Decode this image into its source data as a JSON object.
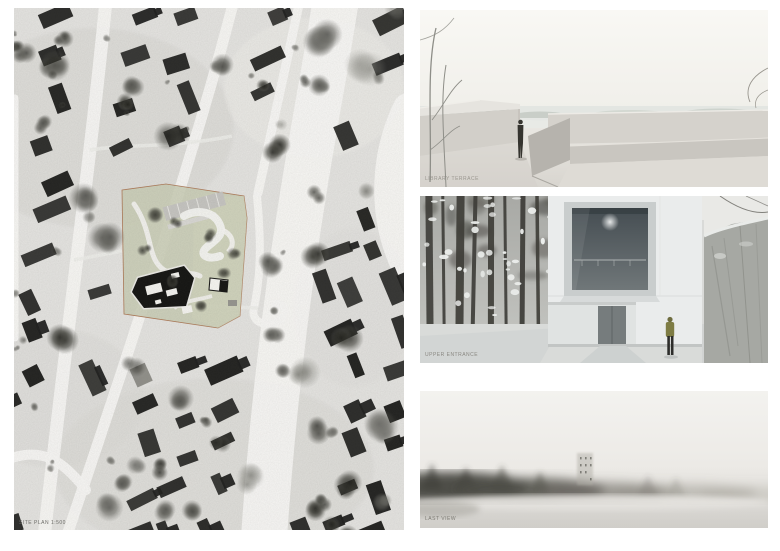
{
  "board": {
    "type_label": "architectural presentation board"
  },
  "site_plan": {
    "label": "SITE PLAN 1:500",
    "colors": {
      "paper": "#e5e4e1",
      "road": "#f8f7f5",
      "building": "#1f1f1d",
      "shed": "#8d8c87",
      "site_fill": "#c9ccb4",
      "site_outline": "#ad7a58",
      "plan_building": "#141412"
    }
  },
  "renders": {
    "terrace": {
      "label": "LIBRARY TERRACE",
      "colors": {
        "sky": "#f9f8f4",
        "haze": "#e3e6e2",
        "concrete_light": "#e6e4df",
        "concrete": "#d2cfc9",
        "concrete_shadow": "#b6b3ad",
        "figure": "#35342f"
      }
    },
    "entrance": {
      "label": "UPPER ENTRANCE",
      "colors": {
        "sky": "#e9e9e6",
        "facade": "#eaecec",
        "glass": "#454d52",
        "door": "#767c7d",
        "forest_trunk": "#3f3e39",
        "snow": "#d9dbd9",
        "rock": "#a6a8a3",
        "person_jacket": "#7e7c44"
      }
    },
    "fog": {
      "label": "LAST VIEW",
      "colors": {
        "mist_top": "#f3f2ef",
        "fog_dark": "#3e3d38",
        "fog_bottom": "#d2d0cc",
        "building_silhouette": "#b0ada6"
      }
    }
  }
}
